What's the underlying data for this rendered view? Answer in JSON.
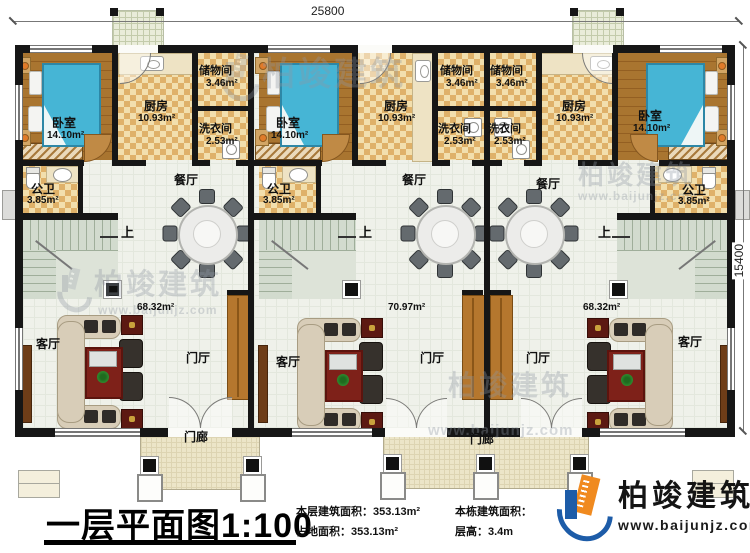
{
  "plan": {
    "title": "一层平面图1:100",
    "dim_top": "25800",
    "dim_right": "15400",
    "up": "上"
  },
  "rooms": {
    "bedroom": "卧室",
    "bedroom_area": "14.10m²",
    "kitchen": "厨房",
    "kitchen_area": "10.93m²",
    "storage": "储物间",
    "storage_area": "3.46m²",
    "laundry": "洗衣间",
    "laundry_area": "2.53m²",
    "bathroom": "公卫",
    "bathroom_area": "3.85m²",
    "dining": "餐厅",
    "living": "客厅",
    "entry_hall": "门厅",
    "porch": "门廊",
    "living_area_left": "68.32m²",
    "living_area_middle": "70.97m²",
    "living_area_right": "68.32m²"
  },
  "stats": {
    "floor_area": "本层建筑面积：353.13m²",
    "land_area": "占地面积：353.13m²",
    "total_area_label": "本栋建筑面积：",
    "story_height": "层高：3.4m"
  },
  "brand": {
    "name": "柏竣建筑",
    "url": "www.baijunjz.com"
  }
}
